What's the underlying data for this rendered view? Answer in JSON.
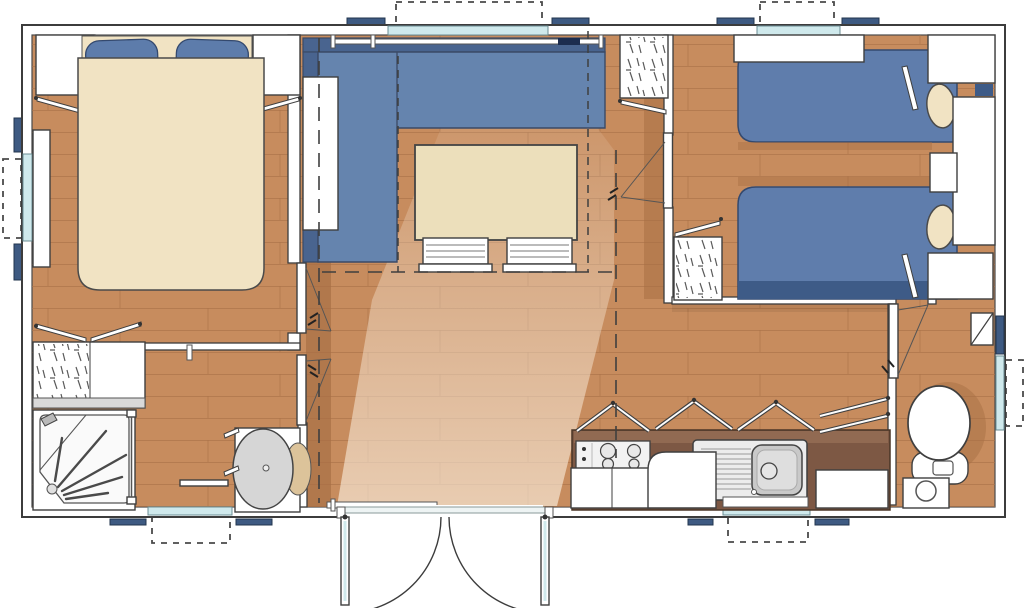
{
  "canvas": {
    "width": 1024,
    "height": 608
  },
  "plan_type": "mobile-home-floor-plan",
  "colors": {
    "floor": "#c78c5e",
    "plank": "#aa7148",
    "floor_shadow": "#a86f44",
    "wall": "#ffffff",
    "outline": "#3c3c3c",
    "glass": "#cfe9ec",
    "shutter": "#3e5a82",
    "navy": "#1c2c4e",
    "sofa": "#6584ae",
    "sofa_back": "#49648f",
    "linen": "#f1e3c3",
    "pillow": "#5d7cab",
    "mattress": "#5f7dac",
    "mattress_foot": "#3e5b87",
    "table": "#ecdfbb",
    "counter": "#7d5844",
    "counter_edge": "#916a52",
    "beige": "#dcc39a",
    "hatch": "#5a5a5a",
    "light": "#fdf3e4"
  },
  "rooms": [
    {
      "id": "master-bedroom",
      "furniture": [
        "double-bed",
        "pillows",
        "wardrobe-left",
        "wardrobe-right",
        "wall-shelf",
        "side-window"
      ]
    },
    {
      "id": "bathroom",
      "furniture": [
        "wardrobe-hatched",
        "shower",
        "washbasin",
        "towel-rail",
        "window"
      ]
    },
    {
      "id": "hallway",
      "furniture": [
        "bedroom-door",
        "bathroom-door"
      ]
    },
    {
      "id": "living-area",
      "furniture": [
        "corner-sofa",
        "dining-table",
        "chair",
        "chair",
        "sideboard",
        "curtain-rail",
        "window"
      ]
    },
    {
      "id": "corridor",
      "furniture": [
        "wardrobe-hatched",
        "bedroom-door"
      ]
    },
    {
      "id": "twin-bedroom",
      "furniture": [
        "single-bed",
        "single-bed",
        "pillows",
        "headboard-cabinets",
        "bedside-table",
        "wall-shelf",
        "window"
      ]
    },
    {
      "id": "kitchen",
      "furniture": [
        "worktop",
        "hob",
        "sink-with-drainer",
        "fridge",
        "base-cabinets",
        "overhead-cupboard-flaps",
        "window"
      ]
    },
    {
      "id": "wc",
      "furniture": [
        "toilet",
        "cistern",
        "corner-shelf",
        "window",
        "door"
      ]
    },
    {
      "id": "entrance",
      "furniture": [
        "double-door",
        "swing-arcs",
        "threshold",
        "grab-rails"
      ]
    }
  ]
}
